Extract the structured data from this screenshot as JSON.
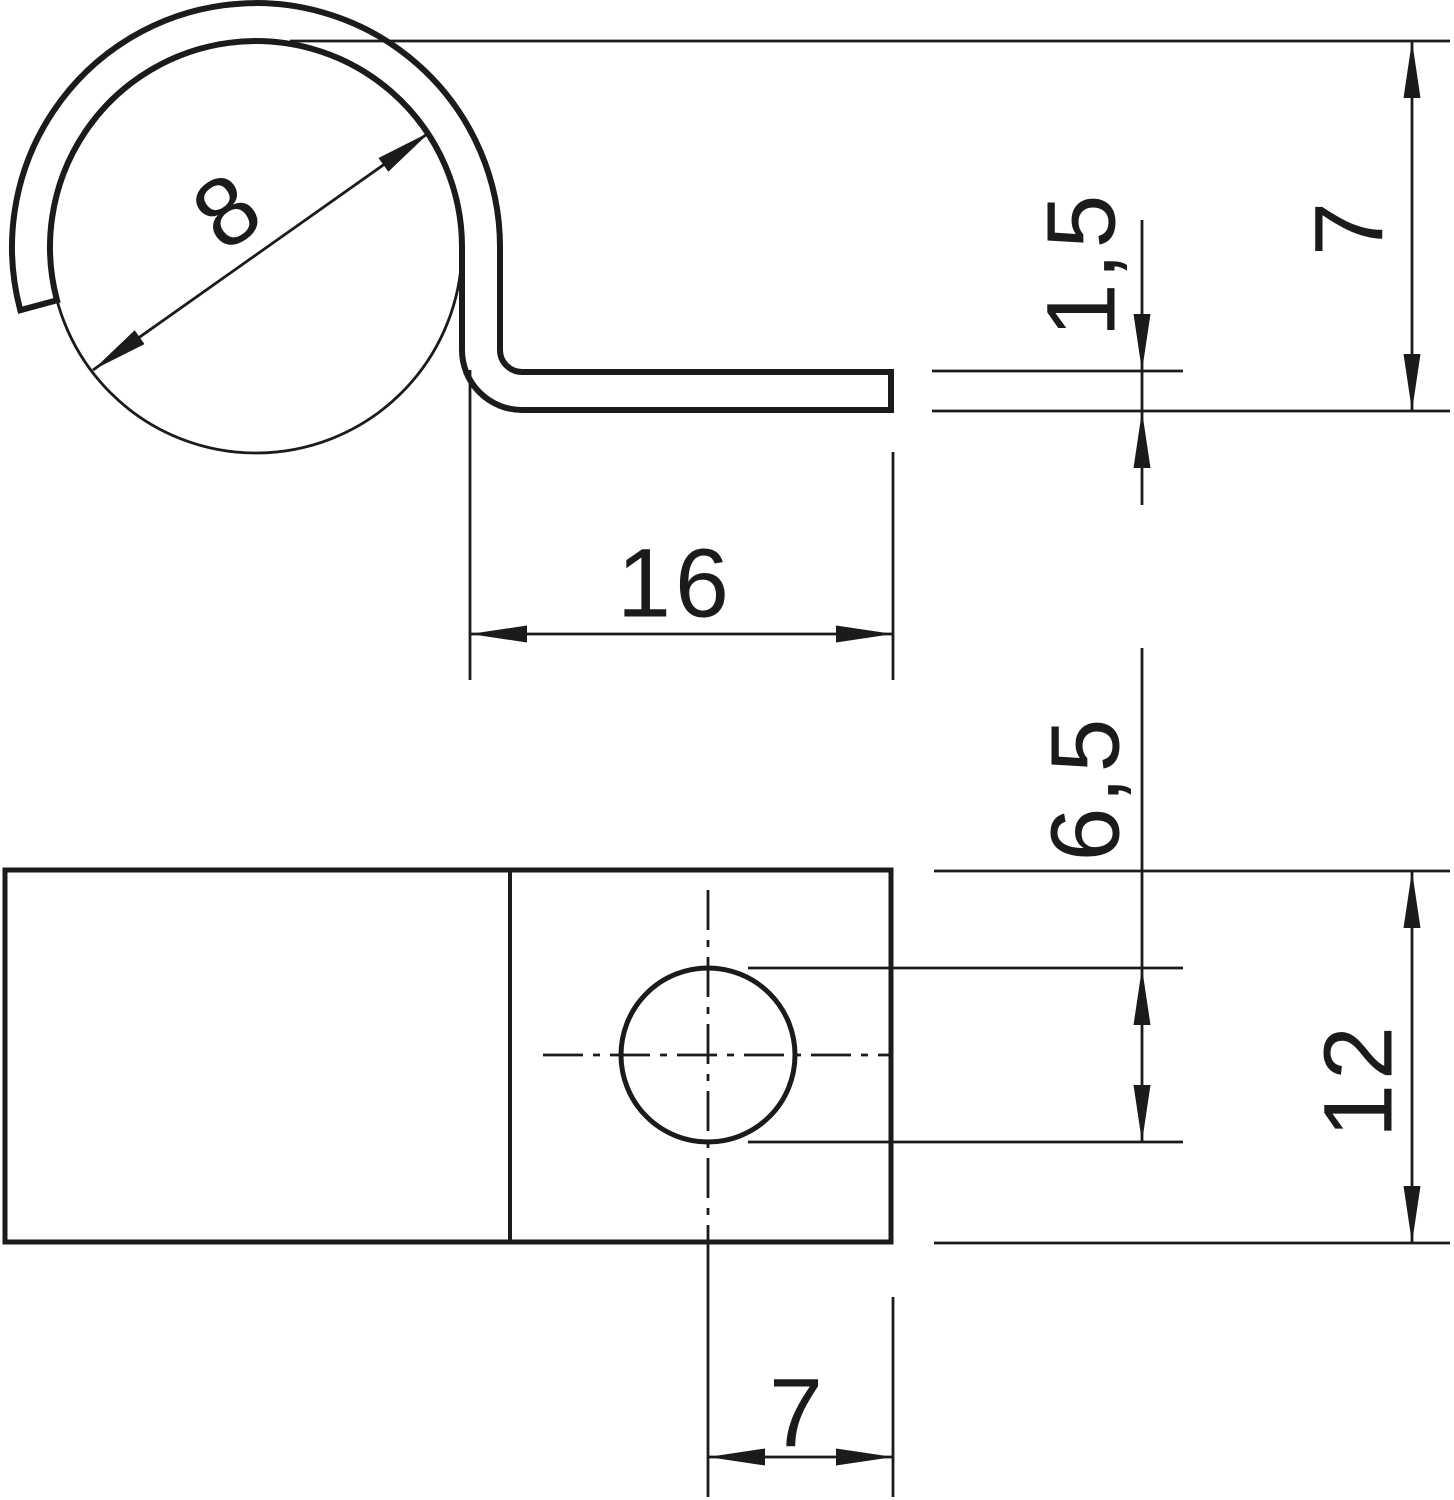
{
  "drawing": {
    "kind": "dimensioned technical drawing of a one-screw cable fixing clip",
    "views": {
      "profile": {
        "dims": {
          "bore_diameter": "8",
          "material_thickness": "1,5",
          "height": "7",
          "tab_length": "16"
        }
      },
      "plan": {
        "dims": {
          "hole_diameter": "6,5",
          "width": "12",
          "hole_edge_offset": "7"
        }
      }
    },
    "colors": {
      "line": "#1b1b1b",
      "background": "#ffffff"
    }
  }
}
